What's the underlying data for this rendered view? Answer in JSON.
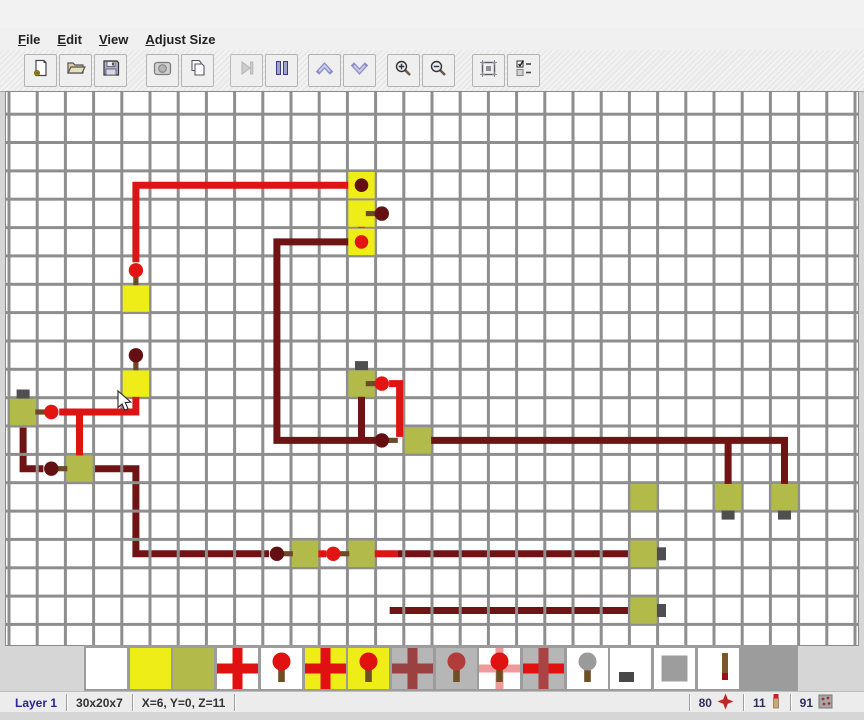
{
  "menu": {
    "items": [
      "File",
      "Edit",
      "View",
      "Adjust Size"
    ]
  },
  "toolbar": {
    "buttons": [
      {
        "name": "new-file-button",
        "icon": "new-file-icon",
        "enabled": true,
        "gap": 24
      },
      {
        "name": "open-file-button",
        "icon": "open-folder-icon",
        "enabled": true,
        "gap": 2
      },
      {
        "name": "save-file-button",
        "icon": "save-floppy-icon",
        "enabled": true,
        "gap": 2
      },
      {
        "name": "export-image-button",
        "icon": "export-image-icon",
        "enabled": true,
        "gap": 19
      },
      {
        "name": "copy-button",
        "icon": "copy-icon",
        "enabled": true,
        "gap": 2
      },
      {
        "name": "step-button",
        "icon": "step-play-icon",
        "enabled": false,
        "gap": 16
      },
      {
        "name": "pause-button",
        "icon": "pause-icon",
        "enabled": true,
        "gap": 2
      },
      {
        "name": "layer-up-button",
        "icon": "chevron-up-icon",
        "enabled": true,
        "gap": 10
      },
      {
        "name": "layer-down-button",
        "icon": "chevron-down-icon",
        "enabled": true,
        "gap": 2
      },
      {
        "name": "zoom-in-button",
        "icon": "zoom-in-icon",
        "enabled": true,
        "gap": 11
      },
      {
        "name": "zoom-out-button",
        "icon": "zoom-out-icon",
        "enabled": true,
        "gap": 2
      },
      {
        "name": "selection-button",
        "icon": "selection-frame-icon",
        "enabled": true,
        "gap": 17
      },
      {
        "name": "options-button",
        "icon": "options-list-icon",
        "enabled": true,
        "gap": 2
      }
    ]
  },
  "canvas": {
    "grid": {
      "cols": 30,
      "rows": 19,
      "cell_w": 28.2,
      "cell_h": 28.35,
      "line_color": "#8e8e8e",
      "bg": "#ffffff"
    },
    "colors": {
      "red": "#dc1414",
      "dark": "#701314",
      "head_lit": "#e41414",
      "head_dark": "#641013",
      "stick": "#6b4a26",
      "yellow": "#eeed18",
      "olive": "#b2ba4a",
      "tab": "#4f4f4f"
    },
    "blocks": [
      {
        "c": 12,
        "r": 3,
        "color": "yellow"
      },
      {
        "c": 12,
        "r": 4,
        "color": "yellow"
      },
      {
        "c": 12,
        "r": 5,
        "color": "yellow"
      },
      {
        "c": 4,
        "r": 7,
        "color": "yellow"
      },
      {
        "c": 4,
        "r": 10,
        "color": "yellow"
      },
      {
        "c": 0,
        "r": 11,
        "color": "olive",
        "tab": "top"
      },
      {
        "c": 2,
        "r": 13,
        "color": "olive"
      },
      {
        "c": 12,
        "r": 10,
        "color": "olive",
        "tab": "top"
      },
      {
        "c": 14,
        "r": 12,
        "color": "olive"
      },
      {
        "c": 22,
        "r": 14,
        "color": "olive"
      },
      {
        "c": 10,
        "r": 16,
        "color": "olive"
      },
      {
        "c": 12,
        "r": 16,
        "color": "olive"
      },
      {
        "c": 22,
        "r": 16,
        "color": "olive",
        "tab": "right"
      },
      {
        "c": 22,
        "r": 18,
        "color": "olive",
        "tab": "right"
      },
      {
        "c": 25,
        "r": 14,
        "color": "olive",
        "tab": "bottom"
      },
      {
        "c": 27,
        "r": 14,
        "color": "olive",
        "tab": "bottom"
      }
    ],
    "wires_under": [
      {
        "color": "dark",
        "pts": [
          [
            0,
            11.55
          ],
          [
            0,
            13
          ],
          [
            0.72,
            13
          ]
        ]
      },
      {
        "color": "dark",
        "pts": [
          [
            2.55,
            13
          ],
          [
            4,
            13
          ],
          [
            4,
            16
          ],
          [
            8.72,
            16
          ]
        ]
      },
      {
        "color": "dark",
        "pts": [
          [
            13.28,
            16
          ],
          [
            21.55,
            16
          ]
        ]
      },
      {
        "color": "dark",
        "pts": [
          [
            13,
            18
          ],
          [
            21.55,
            18
          ]
        ]
      }
    ],
    "wires_over": [
      {
        "color": "red",
        "pts": [
          [
            11.6,
            3
          ],
          [
            4,
            3
          ],
          [
            4,
            5.72
          ]
        ]
      },
      {
        "color": "red",
        "pts": [
          [
            12,
            3.55
          ],
          [
            12,
            4.5
          ]
        ]
      },
      {
        "color": "red",
        "pts": [
          [
            12,
            4
          ],
          [
            12.45,
            4
          ]
        ]
      },
      {
        "color": "red",
        "pts": [
          [
            4,
            10.45
          ],
          [
            4,
            11
          ],
          [
            1.28,
            11
          ]
        ]
      },
      {
        "color": "red",
        "pts": [
          [
            2,
            11
          ],
          [
            2,
            12.6
          ]
        ]
      },
      {
        "color": "red",
        "pts": [
          [
            12.98,
            10
          ],
          [
            13.35,
            10
          ],
          [
            13.35,
            11.88
          ]
        ]
      },
      {
        "color": "red",
        "pts": [
          [
            10.42,
            16
          ],
          [
            10.75,
            16
          ]
        ]
      },
      {
        "color": "red",
        "pts": [
          [
            12.45,
            16
          ],
          [
            13.28,
            16
          ]
        ]
      },
      {
        "color": "dark",
        "pts": [
          [
            11.55,
            5
          ],
          [
            9,
            5
          ],
          [
            9,
            12
          ],
          [
            12.6,
            12
          ]
        ]
      },
      {
        "color": "dark",
        "pts": [
          [
            12,
            10.45
          ],
          [
            12,
            12
          ]
        ]
      },
      {
        "color": "dark",
        "pts": [
          [
            14.45,
            12
          ],
          [
            27,
            12
          ],
          [
            27,
            13.62
          ]
        ]
      },
      {
        "color": "dark",
        "pts": [
          [
            25,
            12
          ],
          [
            25,
            13.62
          ]
        ]
      }
    ],
    "torches": [
      {
        "c": 4,
        "r": 6,
        "dir": "down",
        "lit": true
      },
      {
        "c": 12.72,
        "r": 4,
        "dir": "left",
        "lit": false
      },
      {
        "c": 1,
        "r": 11,
        "dir": "left",
        "lit": true
      },
      {
        "c": 4,
        "r": 9,
        "dir": "down",
        "lit": false
      },
      {
        "c": 12.72,
        "r": 10,
        "dir": "left",
        "lit": true
      },
      {
        "c": 12.72,
        "r": 12,
        "dir": "right",
        "lit": false
      },
      {
        "c": 1,
        "r": 13,
        "dir": "right",
        "lit": false
      },
      {
        "c": 9,
        "r": 16,
        "dir": "right",
        "lit": false
      },
      {
        "c": 11,
        "r": 16,
        "dir": "right",
        "lit": true
      }
    ],
    "dots": [
      {
        "c": 12,
        "r": 3,
        "lit": false
      },
      {
        "c": 12,
        "r": 5,
        "lit": true
      }
    ],
    "cursor": [
      112,
      299
    ]
  },
  "palette": {
    "selected_index": 3,
    "items": [
      {
        "name": "palette-empty",
        "kind": "empty",
        "bg": "#ffffff"
      },
      {
        "name": "palette-yellow-block",
        "kind": "plain",
        "bg": "#eeed18"
      },
      {
        "name": "palette-olive-block",
        "kind": "plain",
        "bg": "#b2ba4a"
      },
      {
        "name": "palette-wire",
        "kind": "cross",
        "bg": "#ffffff",
        "h": "#e01111",
        "v": "#e01111"
      },
      {
        "name": "palette-torch",
        "kind": "torch",
        "bg": "#ffffff",
        "head": "#e01111"
      },
      {
        "name": "palette-wire-on-block",
        "kind": "cross",
        "bg": "#eeed18",
        "h": "#e01111",
        "v": "#e01111"
      },
      {
        "name": "palette-torch-on-block",
        "kind": "torch",
        "bg": "#eeed18",
        "head": "#e01111"
      },
      {
        "name": "palette-wire-off",
        "kind": "cross",
        "bg": "#b6b6b6",
        "h": "#9a4242",
        "v": "#9a4242"
      },
      {
        "name": "palette-torch-off",
        "kind": "torch",
        "bg": "#b6b6b6",
        "head": "#b13c3c"
      },
      {
        "name": "palette-torch-on-wire",
        "kind": "torch-on-wire",
        "bg": "#ffffff",
        "head": "#e01111",
        "cross": "#ef9a9a"
      },
      {
        "name": "palette-wire-mixed",
        "kind": "cross",
        "bg": "#b6b6b6",
        "h": "#e01111",
        "v": "#a84444"
      },
      {
        "name": "palette-torch-unlit",
        "kind": "torch",
        "bg": "#ffffff",
        "head": "#9a9a9a"
      },
      {
        "name": "palette-button",
        "kind": "button",
        "bg": "#ffffff"
      },
      {
        "name": "palette-gray-block",
        "kind": "gray-block",
        "bg": "#ffffff"
      },
      {
        "name": "palette-torch-side",
        "kind": "torch-side",
        "bg": "#ffffff"
      }
    ]
  },
  "status": {
    "left": [
      {
        "name": "layer-indicator",
        "text": "Layer 1"
      },
      {
        "name": "world-size",
        "text": "30x20x7"
      },
      {
        "name": "cursor-position",
        "text": "X=6, Y=0, Z=11"
      }
    ],
    "right": [
      {
        "name": "wire-count",
        "value": "80",
        "icon": "wire-count-icon"
      },
      {
        "name": "torch-count",
        "value": "11",
        "icon": "torch-count-icon"
      },
      {
        "name": "block-count",
        "value": "91",
        "icon": "block-count-icon"
      }
    ]
  }
}
